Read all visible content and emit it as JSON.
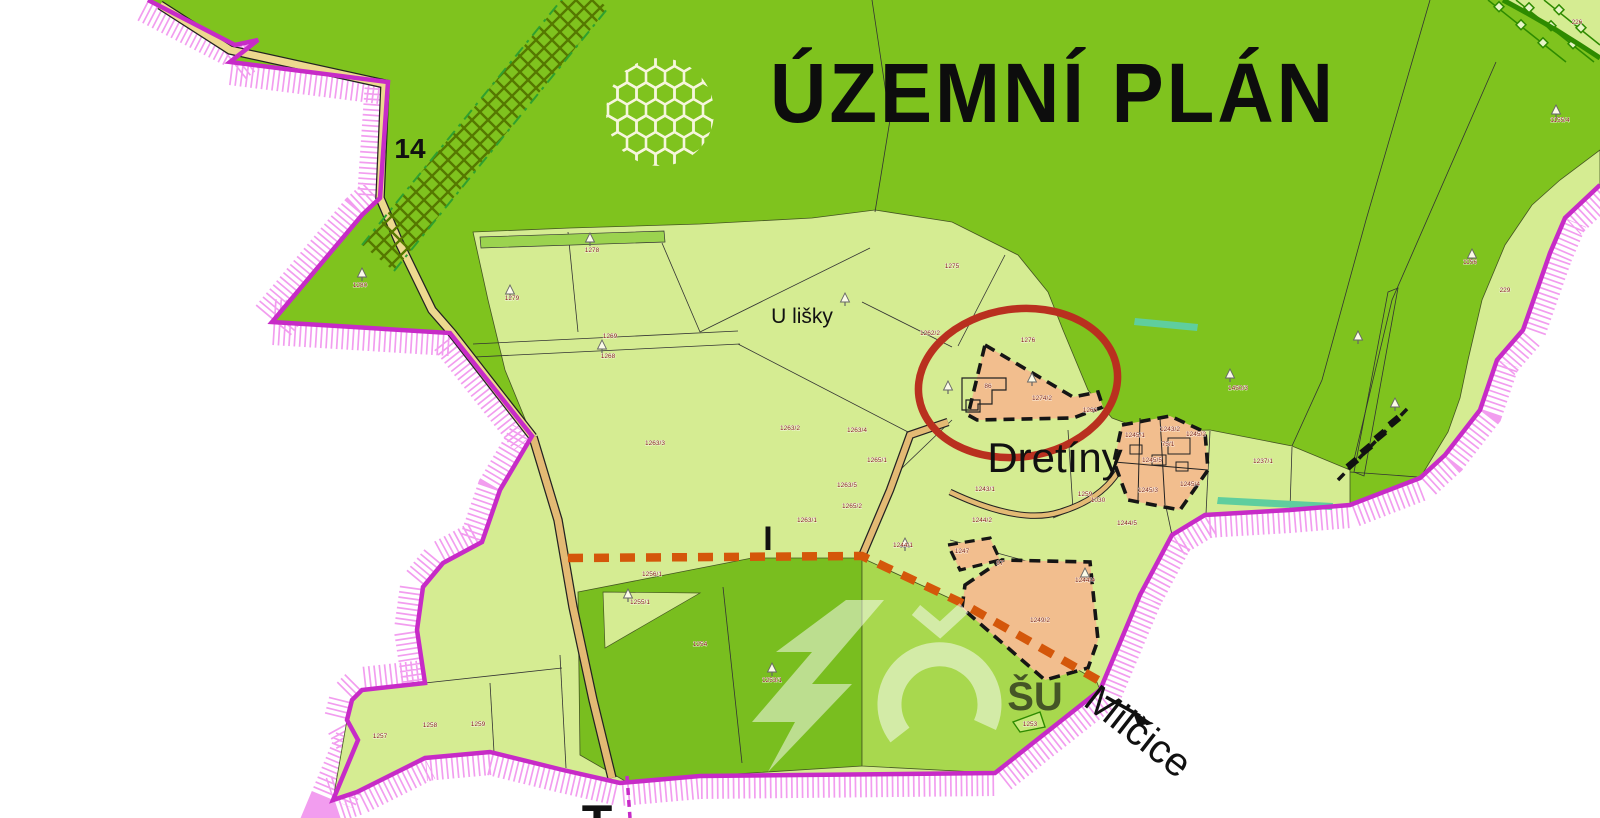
{
  "title": "ÚZEMNÍ PLÁN",
  "place_labels": [
    {
      "text": "U lišky",
      "x": 802,
      "y": 323,
      "size": 21,
      "rot": 0,
      "color": "#111111",
      "weight": "normal",
      "serif": false,
      "opacity": 1
    },
    {
      "text": "Dretíny",
      "x": 1055,
      "y": 472,
      "size": 42,
      "rot": 0,
      "color": "#111111",
      "weight": "normal",
      "serif": false,
      "opacity": 1
    },
    {
      "text": "Milčice",
      "x": 1130,
      "y": 742,
      "size": 40,
      "rot": 38,
      "color": "#111111",
      "weight": "normal",
      "serif": false,
      "opacity": 1
    },
    {
      "text": "T",
      "x": 597,
      "y": 840,
      "size": 50,
      "rot": 0,
      "color": "#111111",
      "weight": "bold",
      "serif": false,
      "opacity": 1
    },
    {
      "text": "14",
      "x": 410,
      "y": 158,
      "size": 28,
      "rot": 0,
      "color": "#1C7A1C",
      "weight": "bold",
      "serif": false,
      "opacity": 1
    },
    {
      "text": "I",
      "x": 768,
      "y": 550,
      "size": 34,
      "rot": 0,
      "color": "#1C7A1C",
      "weight": "bold",
      "serif": true,
      "opacity": 1
    },
    {
      "text": "ŠU",
      "x": 1035,
      "y": 710,
      "size": 40,
      "rot": 0,
      "color": "#FFFFFF",
      "weight": "bold",
      "serif": false,
      "opacity": 0.65
    }
  ],
  "parcel_labels": [
    {
      "t": "1278",
      "x": 592,
      "y": 252
    },
    {
      "t": "1279",
      "x": 512,
      "y": 300
    },
    {
      "t": "1269",
      "x": 610,
      "y": 338
    },
    {
      "t": "1268",
      "x": 608,
      "y": 358
    },
    {
      "t": "1275",
      "x": 952,
      "y": 268
    },
    {
      "t": "1262/2",
      "x": 930,
      "y": 335
    },
    {
      "t": "1263/3",
      "x": 655,
      "y": 445
    },
    {
      "t": "1263/4",
      "x": 857,
      "y": 432
    },
    {
      "t": "1265/1",
      "x": 877,
      "y": 462
    },
    {
      "t": "1263/5",
      "x": 847,
      "y": 487
    },
    {
      "t": "1263/1",
      "x": 807,
      "y": 522
    },
    {
      "t": "1265/2",
      "x": 852,
      "y": 508
    },
    {
      "t": "1263/2",
      "x": 790,
      "y": 430
    },
    {
      "t": "1256/1",
      "x": 652,
      "y": 576
    },
    {
      "t": "1255/1",
      "x": 640,
      "y": 604
    },
    {
      "t": "1254",
      "x": 700,
      "y": 646
    },
    {
      "t": "1253/1",
      "x": 772,
      "y": 682
    },
    {
      "t": "1280",
      "x": 360,
      "y": 287
    },
    {
      "t": "1276",
      "x": 1028,
      "y": 342
    },
    {
      "t": "1274/2",
      "x": 1042,
      "y": 400
    },
    {
      "t": "86",
      "x": 988,
      "y": 388
    },
    {
      "t": "1266",
      "x": 1090,
      "y": 412
    },
    {
      "t": "1245/1",
      "x": 1135,
      "y": 437
    },
    {
      "t": "1243/2",
      "x": 1170,
      "y": 431
    },
    {
      "t": "75/1",
      "x": 1168,
      "y": 446
    },
    {
      "t": "1245/2",
      "x": 1196,
      "y": 436
    },
    {
      "t": "1245/3",
      "x": 1148,
      "y": 492
    },
    {
      "t": "1245/4",
      "x": 1190,
      "y": 486
    },
    {
      "t": "1245/5",
      "x": 1152,
      "y": 462
    },
    {
      "t": "1243/1",
      "x": 985,
      "y": 491
    },
    {
      "t": "1259",
      "x": 1085,
      "y": 496
    },
    {
      "t": "1244/2",
      "x": 982,
      "y": 522
    },
    {
      "t": "1244/5",
      "x": 1127,
      "y": 525
    },
    {
      "t": "1244/4",
      "x": 1085,
      "y": 582
    },
    {
      "t": "1249/2",
      "x": 1040,
      "y": 622
    },
    {
      "t": "1247",
      "x": 962,
      "y": 553
    },
    {
      "t": "97",
      "x": 1000,
      "y": 565
    },
    {
      "t": "1244/1",
      "x": 903,
      "y": 547
    },
    {
      "t": "1237/1",
      "x": 1263,
      "y": 463
    },
    {
      "t": "1450/3",
      "x": 1238,
      "y": 390
    },
    {
      "t": "229",
      "x": 1505,
      "y": 292
    },
    {
      "t": "226",
      "x": 1577,
      "y": 24
    },
    {
      "t": "1155/4",
      "x": 1560,
      "y": 122
    },
    {
      "t": "1156",
      "x": 1470,
      "y": 264
    },
    {
      "t": "1258",
      "x": 430,
      "y": 727
    },
    {
      "t": "1259",
      "x": 478,
      "y": 726
    },
    {
      "t": "1257",
      "x": 380,
      "y": 738
    },
    {
      "t": "1253",
      "x": 1030,
      "y": 726
    },
    {
      "t": "1030",
      "x": 1098,
      "y": 502
    }
  ],
  "trees": [
    [
      362,
      275
    ],
    [
      590,
      240
    ],
    [
      510,
      292
    ],
    [
      602,
      347
    ],
    [
      845,
      300
    ],
    [
      948,
      388
    ],
    [
      1032,
      380
    ],
    [
      1230,
      376
    ],
    [
      1395,
      405
    ],
    [
      1358,
      338
    ],
    [
      1472,
      256
    ],
    [
      1556,
      112
    ],
    [
      628,
      596
    ],
    [
      772,
      670
    ],
    [
      905,
      545
    ],
    [
      1085,
      575
    ]
  ],
  "colors": {
    "background_outside": "#FFFFFF",
    "forest_green": "#7FC31E",
    "field_light_green": "#D5EC92",
    "meadow_mid_green": "#79BE1F",
    "south_mid_green": "#A8D84E",
    "development_orange": "#F2BE8E",
    "boundary_magenta": "#C72BC7",
    "boundary_hatch_pink": "#F08CEC",
    "road_dash_orange": "#D4570A",
    "zone_dash_black": "#151515",
    "highlight_ellipse_red": "#B9301F",
    "parcel_number_red": "#7B1A00",
    "map_symbol_green": "#1C7A1C",
    "teal_sliver": "#5FCE9E",
    "road_tan": "#E3BA74",
    "road_yellow": "#EDD98F"
  }
}
